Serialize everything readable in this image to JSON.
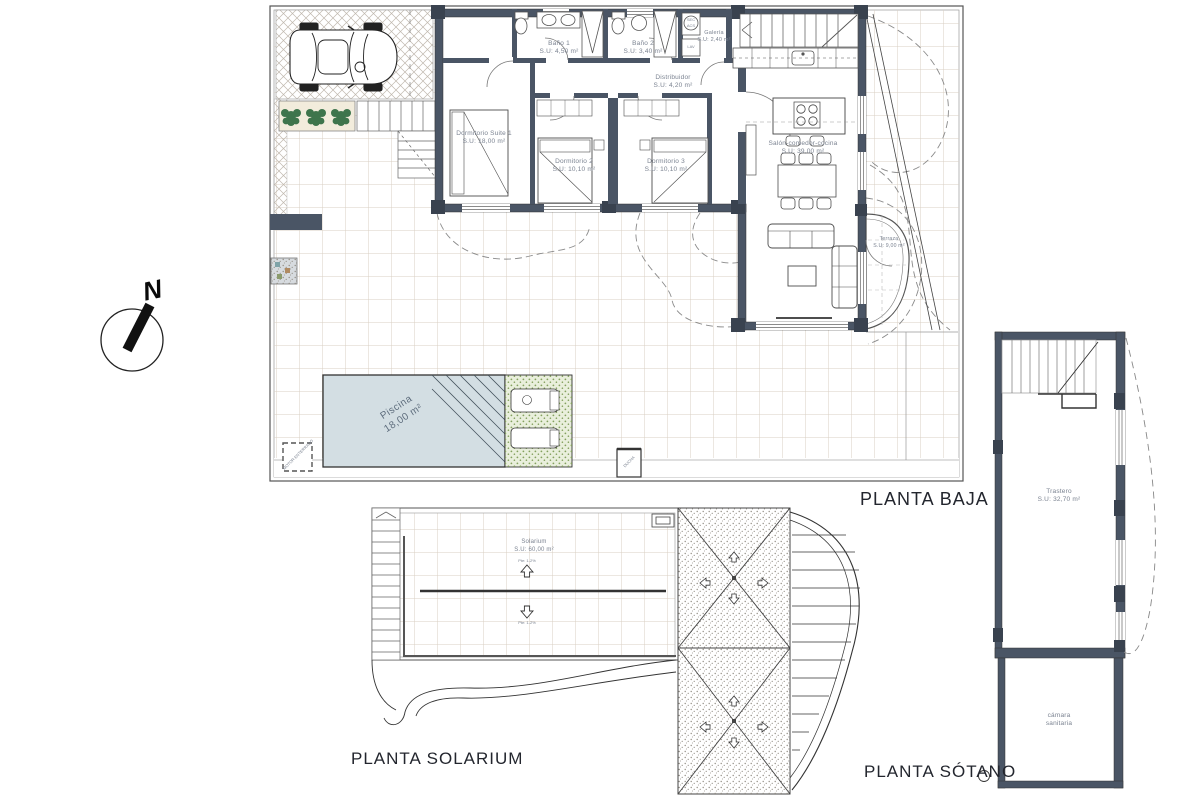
{
  "titles": {
    "baja": "PLANTA BAJA",
    "solarium": "PLANTA SOLARIUM",
    "sotano": "PLANTA SÓTANO"
  },
  "compass": {
    "north": "N"
  },
  "ground_floor": {
    "rooms": [
      {
        "name": "Dormitorio Suite 1",
        "area": "S.U: 18,00 m²"
      },
      {
        "name": "Dormitorio 2",
        "area": "S.U: 10,10 m²"
      },
      {
        "name": "Dormitorio 3",
        "area": "S.U: 10,10 m²"
      },
      {
        "name": "Baño 1",
        "area": "S.U: 4,50 m²"
      },
      {
        "name": "Baño 2",
        "area": "S.U: 3,40 m²"
      },
      {
        "name": "Galería",
        "area": "S.U: 2,40 m²"
      },
      {
        "name": "Distribuidor",
        "area": "S.U: 4,20 m²"
      },
      {
        "name": "Salón-comedor-cocina",
        "area": "S.U: 39,00 m²"
      },
      {
        "name": "Terraza",
        "area": "S.U: 9,00 m²"
      }
    ],
    "pool": {
      "name": "Piscina",
      "area": "18,00 m²"
    },
    "motor_label": "MOTOR ENTERRADO",
    "ducha_label": "DUCHA",
    "appliances": {
      "sec": "SEC",
      "acs": "ACS",
      "lav": "LAV"
    }
  },
  "solarium": {
    "room": {
      "name": "Solarium",
      "area": "S.U: 60,00 m²"
    },
    "slope_label_1": "Pte: 1-2%",
    "slope_label_2": "Pte: 1-2%"
  },
  "basement": {
    "rooms": [
      {
        "name": "Trastero",
        "area": "S.U: 32,70 m²"
      },
      {
        "name": "cámara",
        "area": "sanitaria"
      }
    ]
  },
  "colors": {
    "wall": "#4a5565",
    "pool_fill": "#d3dee3",
    "deck_green": "#e9efdc",
    "plant_green": "#2f6b40",
    "tile_line": "#d9cfc3",
    "label_text": "#7b8391",
    "title_text": "#23262e"
  }
}
